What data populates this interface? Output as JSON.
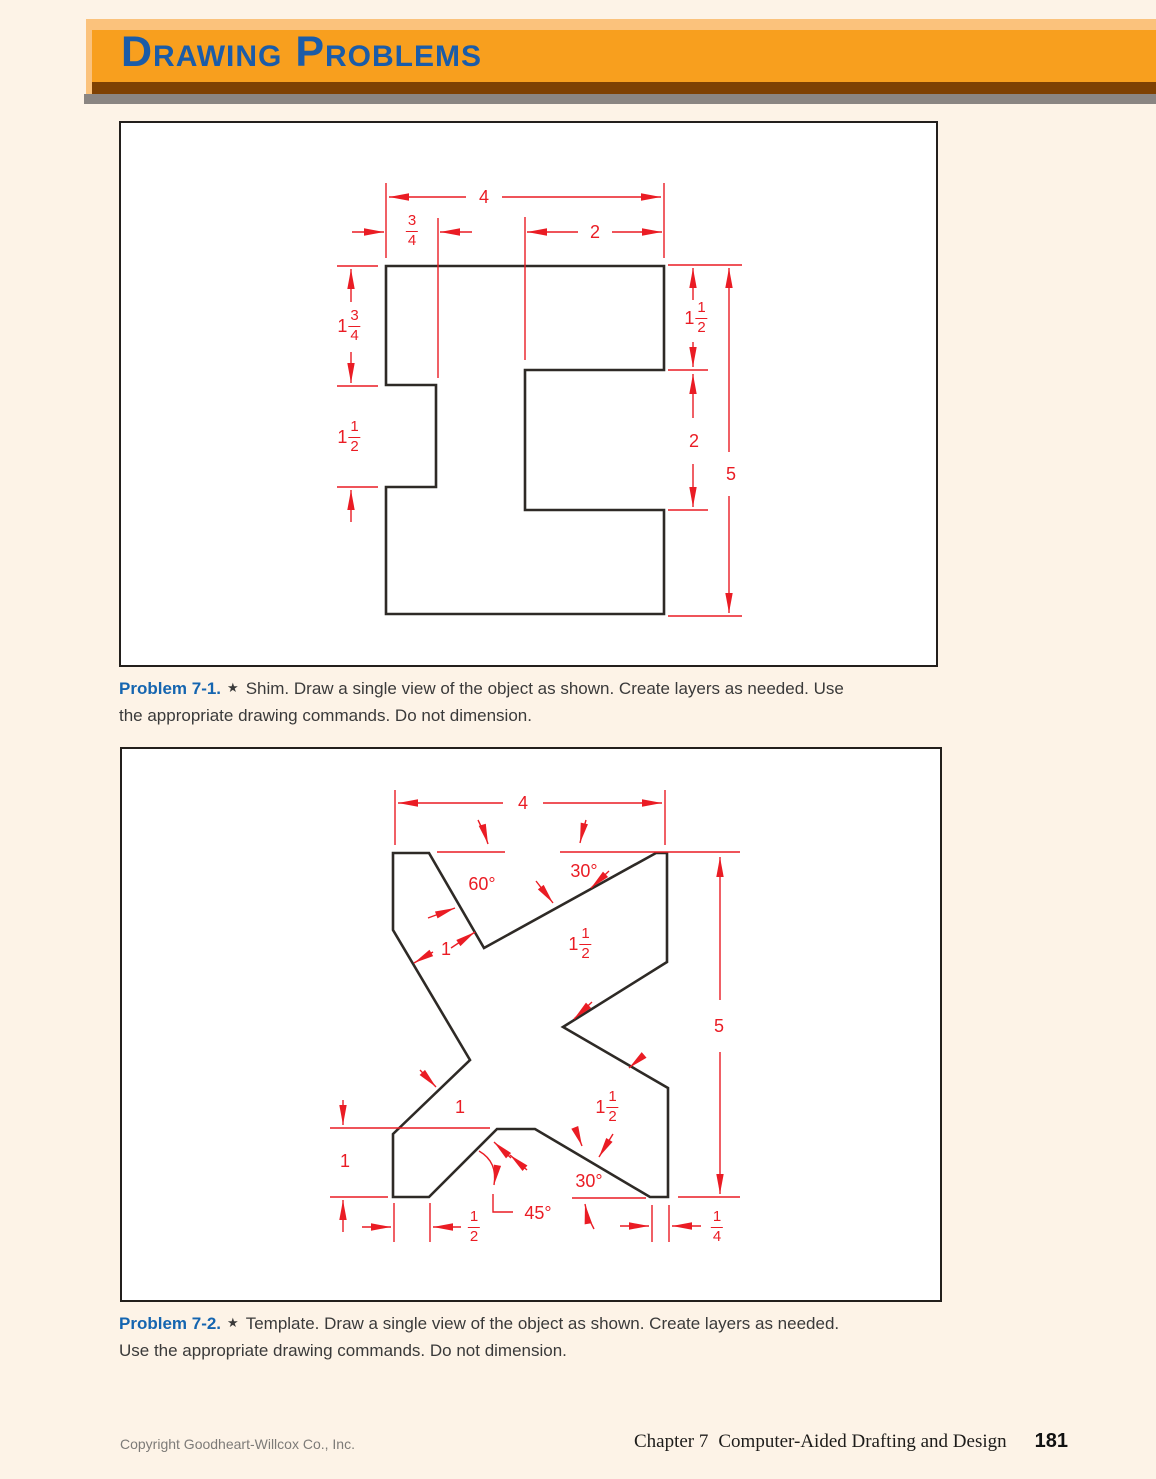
{
  "banner": {
    "title": "Drawing Problems"
  },
  "problem1": {
    "label": "Problem 7-1.",
    "star": "★",
    "line1": "Shim. Draw a single view of the object as shown. Create layers as needed. Use",
    "line2": "the appropriate drawing commands. Do not dimension."
  },
  "problem2": {
    "label": "Problem 7-2.",
    "star": "★",
    "line1": "Template. Draw a single view of the object as shown. Create layers as needed.",
    "line2": "Use the appropriate drawing commands. Do not dimension."
  },
  "footer": {
    "copyright": "Copyright Goodheart-Willcox Co., Inc.",
    "chapter": "Chapter 7",
    "chapter_title": "Computer-Aided Drafting and Design",
    "page_number": "181"
  },
  "colors": {
    "dimension_red": "#ea1c24",
    "line_black": "#2e2a26",
    "banner_orange": "#f89f1e",
    "banner_highlight": "#fbc27c",
    "banner_shade": "#7e4103",
    "title_blue": "#1b5ca8",
    "caption_blue": "#1565b0",
    "page_cream": "#fdf3e7"
  },
  "fig1": {
    "name": "Shim single view",
    "labels": {
      "width4": "4",
      "threequarter": {
        "num": "3",
        "den": "4"
      },
      "two_top": "2",
      "one_three_quarter": {
        "whole": "1",
        "num": "3",
        "den": "4"
      },
      "one_half_left": {
        "whole": "1",
        "num": "1",
        "den": "2"
      },
      "one_half_right": {
        "whole": "1",
        "num": "1",
        "den": "2"
      },
      "two_right": "2",
      "five": "5"
    }
  },
  "fig2": {
    "name": "Template single view",
    "labels": {
      "width4": "4",
      "angle60": "60°",
      "angle30_top": "30°",
      "one_top": "1",
      "one_half_mid": {
        "whole": "1",
        "num": "1",
        "den": "2"
      },
      "five": "5",
      "one_horiz": "1",
      "one_left": "1",
      "one_half_low": {
        "whole": "1",
        "num": "1",
        "den": "2"
      },
      "angle45": "45°",
      "angle30_bottom": "30°",
      "half": {
        "num": "1",
        "den": "2"
      },
      "quarter": {
        "num": "1",
        "den": "4"
      }
    }
  }
}
